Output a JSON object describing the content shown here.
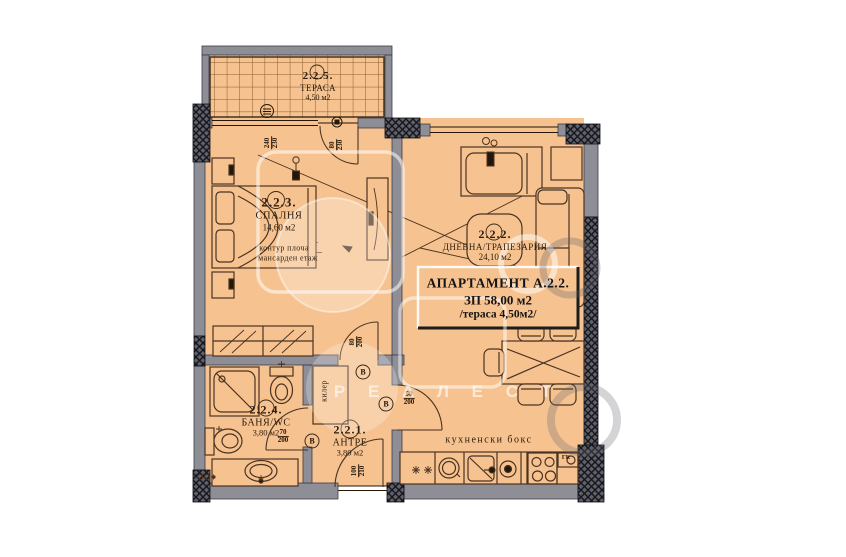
{
  "rooms": {
    "terrace": {
      "number": "2.2.5.",
      "name": "ТЕРАСА",
      "area": "4,50 м2"
    },
    "bedroom": {
      "number": "2.2.3.",
      "name": "СПАЛНЯ",
      "area": "14,60 м2"
    },
    "living": {
      "number": "2.2.2.",
      "name": "ДНЕВНА/ТРАПЕЗАРИЯ",
      "area": "24,10 м2"
    },
    "bath": {
      "number": "2.2.4.",
      "name": "БАНЯ/WC",
      "area": "3,80 м2"
    },
    "entry": {
      "number": "2.2.1.",
      "name": "АНТРЕ",
      "area": "3,80 м2"
    }
  },
  "apartment": {
    "title": "АПАРТАМЕНТ А.2.2.",
    "built_area": "ЗП 58,00 м2",
    "terrace_area": "/тераса 4,50м2/"
  },
  "notes": {
    "slab1": "контур плоча",
    "slab2": "мансарден етаж",
    "closet": "килер",
    "kitchen": "кухненски бокс",
    "gas": "ГК",
    "vent": "В"
  },
  "dims": {
    "terrace_window": {
      "top": "240",
      "bottom": "230"
    },
    "terrace_door": {
      "top": "80",
      "bottom": "230"
    },
    "bedroom_door": {
      "top": "80",
      "bottom": "200"
    },
    "bath_door": {
      "top": "70",
      "bottom": "200"
    },
    "kitchen_door": {
      "top": "90",
      "bottom": "200"
    },
    "entry_door": {
      "top": "100",
      "bottom": "210"
    }
  },
  "watermark": {
    "letters": "Р Е А Л  Е С Т"
  },
  "colors": {
    "floor": "#f6c28f",
    "wall": "#8e8e96",
    "wall_dark": "#45454e",
    "line": "#4a3322"
  }
}
